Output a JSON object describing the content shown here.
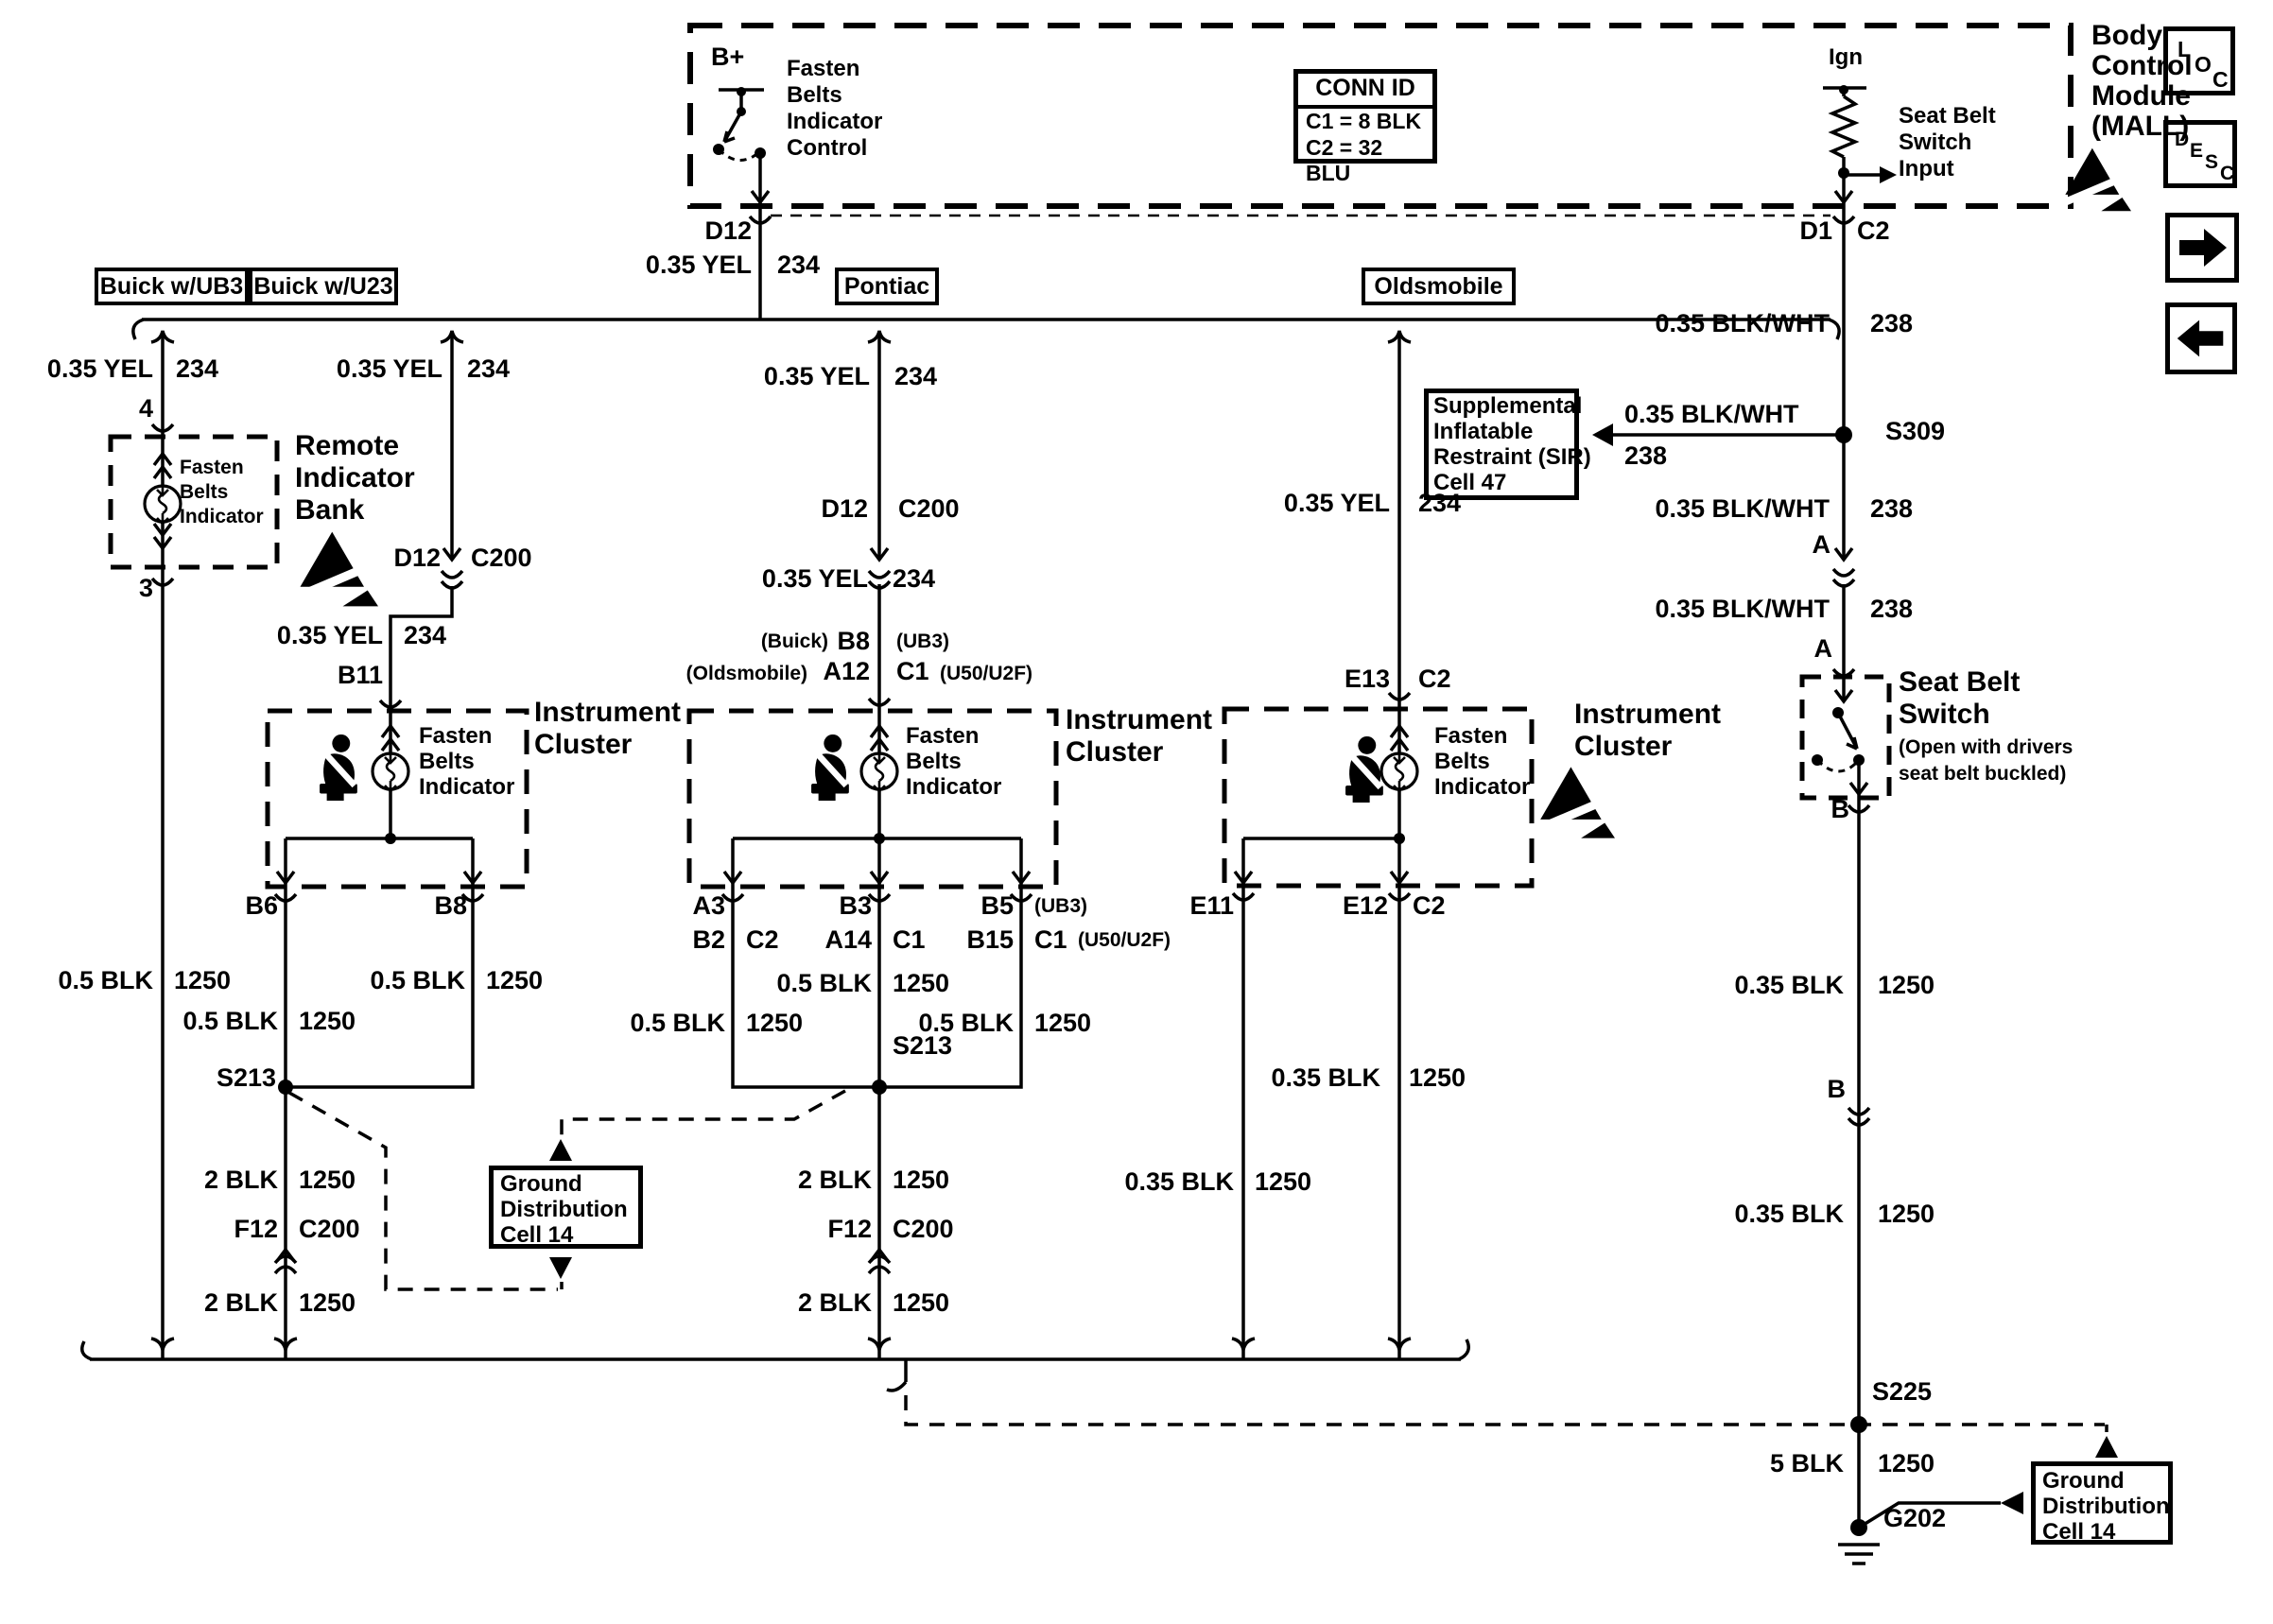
{
  "bcm": {
    "title": [
      "Body",
      "Control",
      "Module",
      "(MALL)"
    ],
    "control_label": [
      "Fasten",
      "Belts",
      "Indicator",
      "Control"
    ],
    "b_plus": "B+",
    "ign": "Ign",
    "sbs_input": [
      "Seat Belt",
      "Switch",
      "Input"
    ]
  },
  "conn_id": {
    "header": "CONN ID",
    "row1": "C1 = 8 BLK",
    "row2": "C2 = 32 BLU"
  },
  "branch_boxes": {
    "ub3": "Buick w/UB3",
    "u23": "Buick w/U23",
    "pontiac": "Pontiac",
    "olds": "Oldsmobile"
  },
  "wire": {
    "yel": "0.35 YEL",
    "c234": "234",
    "blkwht": "0.35 BLK/WHT",
    "c238": "238",
    "blk05": "0.5 BLK",
    "blk2": "2 BLK",
    "blk035": "0.35 BLK",
    "blk5": "5 BLK",
    "c1250": "1250"
  },
  "pins": {
    "p4": "4",
    "p3": "3",
    "d12": "D12",
    "c200": "C200",
    "b11": "B11",
    "b6": "B6",
    "b8": "B8",
    "a3": "A3",
    "b2": "B2",
    "b3": "B3",
    "a14": "A14",
    "a12": "A12",
    "b5": "B5",
    "b15": "B15",
    "c1": "C1",
    "c2": "C2",
    "e11": "E11",
    "e12": "E12",
    "e13": "E13",
    "d1": "D1",
    "a": "A",
    "b": "B",
    "f12": "F12",
    "note_ub3": "(UB3)",
    "note_u50": "(U50/U2F)",
    "note_buick": "(Buick)",
    "note_olds": "(Oldsmobile)"
  },
  "splices": {
    "s213": "S213",
    "s309": "S309",
    "s225": "S225",
    "g202": "G202"
  },
  "blocks": {
    "remote": [
      "Remote",
      "Indicator",
      "Bank"
    ],
    "cluster": [
      "Instrument",
      "Cluster"
    ],
    "fasten": [
      "Fasten",
      "Belts",
      "Indicator"
    ],
    "sir": [
      "Supplemental",
      "Inflatable",
      "Restraint (SIR)",
      "Cell 47"
    ],
    "gd": [
      "Ground",
      "Distribution",
      "Cell 14"
    ],
    "sbs_title": [
      "Seat Belt",
      "Switch"
    ],
    "sbs_note": [
      "(Open with drivers",
      "seat belt buckled)"
    ]
  },
  "nav": {
    "loc": [
      "L",
      "O",
      "C"
    ],
    "desc": [
      "D",
      "E",
      "S",
      "C"
    ]
  }
}
